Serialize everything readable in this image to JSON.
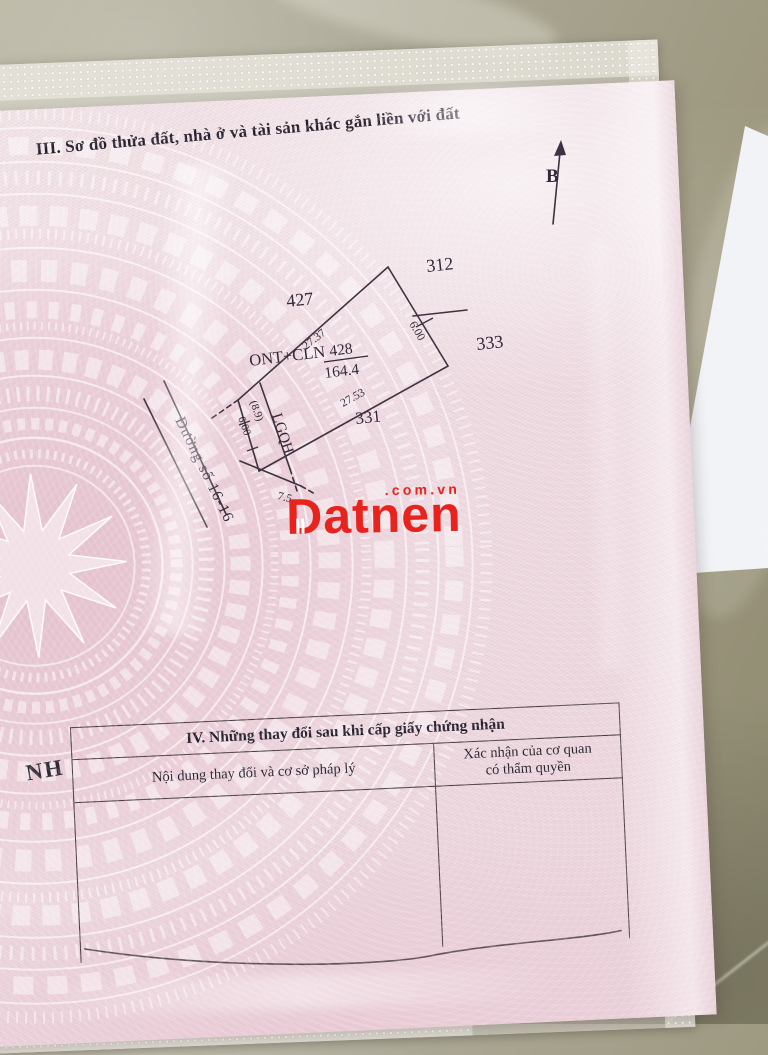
{
  "document": {
    "section3": {
      "title": "III. Sơ đồ thửa đất, nhà ở và tài sản khác gắn liền với đất"
    },
    "north_label": "B",
    "diagram": {
      "neighbor_plots": {
        "top_left": "427",
        "top_right": "312",
        "right": "333",
        "bottom": "331"
      },
      "plot": {
        "land_use_code": "ONT+CLN",
        "parcel_number": "428",
        "area": "164.4"
      },
      "dimensions": {
        "top_edge": "27.37",
        "bottom_edge": "27.53",
        "right_edge": "6.00",
        "left_edge_upper": "(8.9)",
        "left_edge_lower": "6.00",
        "front_edge": "7.5"
      },
      "planning_boundary_label": "LGQH",
      "road_label": "Đường số 16-16"
    },
    "partial_text_fragment": "NH",
    "section4": {
      "title": "IV. Những thay đổi sau khi cấp giấy chứng nhận",
      "column1_header": "Nội dung thay đổi và cơ sở pháp lý",
      "column2_header_line1": "Xác nhận của cơ quan",
      "column2_header_line2": "có thẩm quyền"
    }
  },
  "watermark": {
    "brand": "Datnen",
    "domain": ".com.vn",
    "color": "#e8231e"
  },
  "colors": {
    "sheet_pink": "#eedce2",
    "drum_pattern": "#e2bdca",
    "ink": "#3e3340",
    "tile_floor": "#a19c85",
    "loose_paper": "#eef0f5"
  }
}
